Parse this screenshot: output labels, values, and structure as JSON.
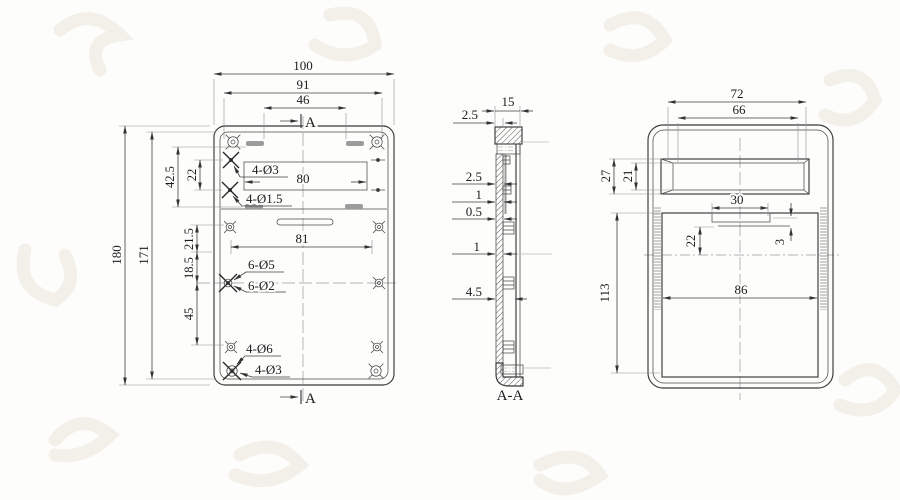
{
  "drawing": {
    "type": "engineering-drawing",
    "views": [
      "front-view",
      "section-view-A-A",
      "back-view"
    ]
  },
  "colors": {
    "line": "#3a3a3a",
    "dimension_text": "#1c1c1c",
    "extension_line": "#8f8f8f",
    "slot_fill": "#9c9c9c",
    "background": "#fdfdfc",
    "watermark": "#f3f0ea"
  },
  "front": {
    "overall_width": "100",
    "inner_width": "91",
    "top_slot_span": "46",
    "overall_height": "180",
    "inner_height": "171",
    "upper_offset": "42.5",
    "hole_row_gap": "22",
    "mid_gap_a": "21.5",
    "mid_gap_b": "18.5",
    "lower_gap": "45",
    "window_width": "80",
    "hole_span": "81",
    "holes_top_1": "4-Ø3",
    "holes_top_2": "4-Ø1.5",
    "holes_mid_1": "6-Ø5",
    "holes_mid_2": "6-Ø2",
    "holes_bottom_1": "4-Ø6",
    "holes_bottom_2": "4-Ø3",
    "section_arrow": "A"
  },
  "section": {
    "depth": "15",
    "top_wall": "2.5",
    "wall_a": "2.5",
    "wall_b": "1",
    "wall_c": "0.5",
    "wall_d": "1",
    "boss_depth": "4.5",
    "title": "A-A"
  },
  "back": {
    "window_outer_width": "72",
    "window_inner_width": "66",
    "window_outer_height": "27",
    "window_inner_height": "21",
    "clip_width": "30",
    "clip_offset": "22",
    "clip_thickness": "3",
    "cavity_height": "113",
    "cavity_width": "86"
  }
}
